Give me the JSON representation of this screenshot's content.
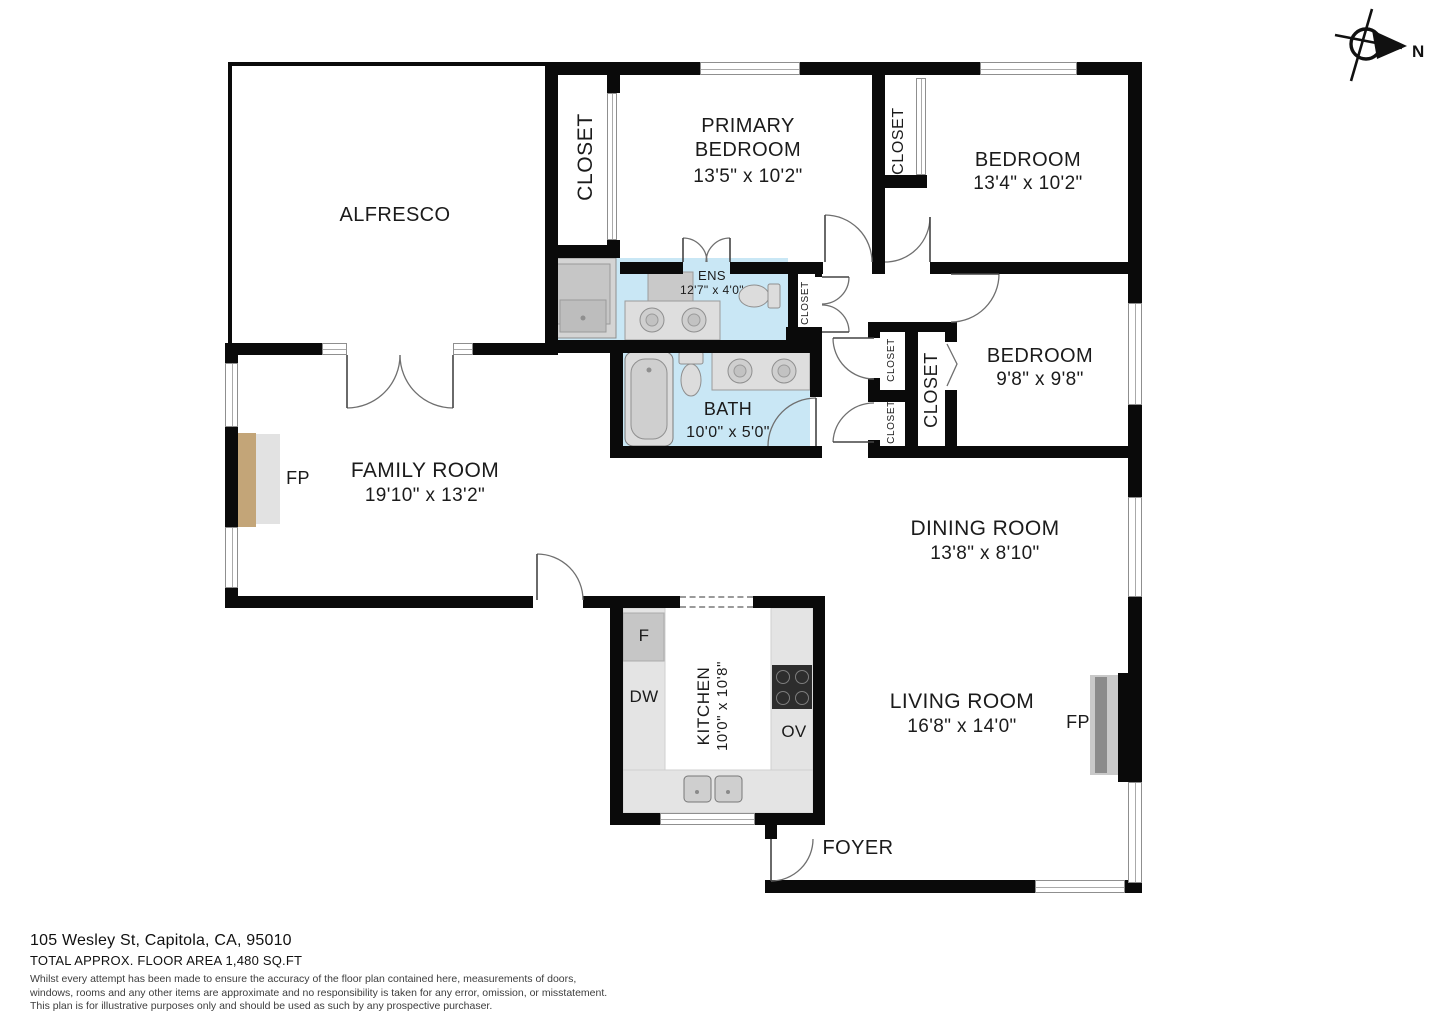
{
  "compass": {
    "label": "N"
  },
  "rooms": {
    "alfresco": {
      "label": "ALFRESCO"
    },
    "primary_bedroom": {
      "line1": "PRIMARY",
      "line2": "BEDROOM",
      "dims": "13'5\" x 10'2\""
    },
    "bedroom2": {
      "label": "BEDROOM",
      "dims": "13'4\" x 10'2\""
    },
    "bedroom3": {
      "label": "BEDROOM",
      "dims": "9'8\" x 9'8\""
    },
    "ens": {
      "label": "ENS",
      "dims": "12'7\" x 4'0\""
    },
    "bath": {
      "label": "BATH",
      "dims": "10'0\" x 5'0\""
    },
    "family_room": {
      "label": "FAMILY ROOM",
      "dims": "19'10\" x 13'2\""
    },
    "dining_room": {
      "label": "DINING ROOM",
      "dims": "13'8\" x 8'10\""
    },
    "kitchen": {
      "label": "KITCHEN",
      "dims": "10'0\" x 10'8\""
    },
    "living_room": {
      "label": "LIVING ROOM",
      "dims": "16'8\" x 14'0\""
    },
    "foyer": {
      "label": "FOYER"
    }
  },
  "closets": {
    "left": "CLOSET",
    "primary2": "CLOSET",
    "hall": "CLOSET",
    "small_top": "CLOSET",
    "small_bottom": "CLOSET",
    "bedroom3": "CLOSET"
  },
  "fixtures": {
    "fireplace_family": "FP",
    "fireplace_living": "FP",
    "fridge": "F",
    "dishwasher": "DW",
    "oven": "OV"
  },
  "colors": {
    "wall": "#0a0a0a",
    "bath_floor": "#c9e7f5",
    "fireplace_tan": "#c3a578",
    "counter_gray": "#e4e4e4",
    "fixture_gray": "#cfcfcf"
  },
  "footer": {
    "address": "105 Wesley St, Capitola, CA, 95010",
    "area": "TOTAL APPROX. FLOOR AREA 1,480 SQ.FT",
    "disclaimer_line1": "Whilst every attempt has been made to ensure the accuracy of the floor plan contained here, measurements of doors,",
    "disclaimer_line2": "windows, rooms and any other items are approximate and no responsibility is taken for any error, omission, or misstatement.",
    "disclaimer_line3": "This plan is for illustrative purposes only and should be used as such by any prospective purchaser."
  }
}
